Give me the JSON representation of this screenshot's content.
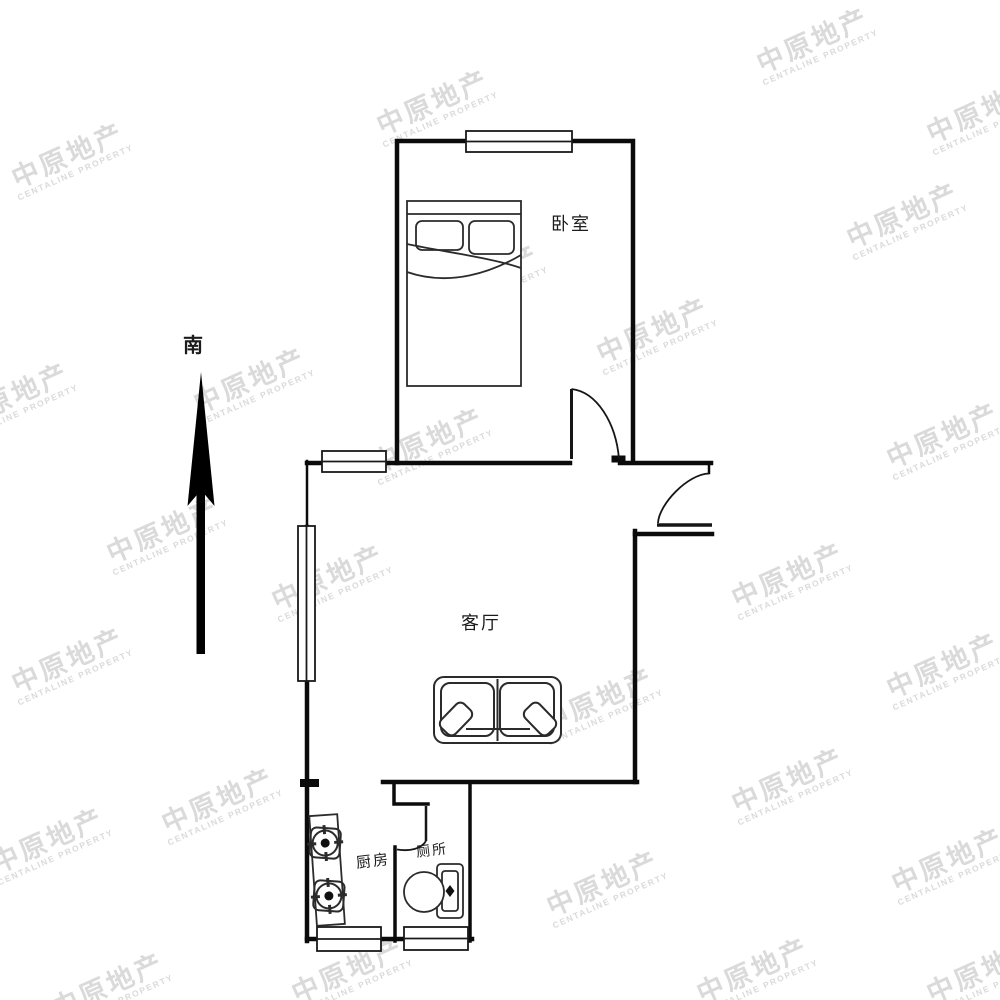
{
  "meta": {
    "background": "#ffffff",
    "line_color": "#111111",
    "furniture_color": "#2b2b2b"
  },
  "watermark": {
    "line1": "中原地产",
    "line2": "CENTALINE PROPERTY",
    "color": "#dadada",
    "rotation_deg": -24,
    "positions": [
      [
        70,
        160
      ],
      [
        435,
        107
      ],
      [
        815,
        45
      ],
      [
        985,
        115
      ],
      [
        15,
        400
      ],
      [
        252,
        385
      ],
      [
        485,
        282
      ],
      [
        655,
        335
      ],
      [
        905,
        220
      ],
      [
        165,
        535
      ],
      [
        430,
        445
      ],
      [
        945,
        440
      ],
      [
        70,
        665
      ],
      [
        330,
        582
      ],
      [
        790,
        580
      ],
      [
        600,
        705
      ],
      [
        945,
        670
      ],
      [
        50,
        845
      ],
      [
        220,
        805
      ],
      [
        790,
        785
      ],
      [
        950,
        865
      ],
      [
        110,
        990
      ],
      [
        350,
        975
      ],
      [
        605,
        888
      ],
      [
        755,
        975
      ],
      [
        985,
        975
      ]
    ]
  },
  "compass": {
    "label": "南"
  },
  "rooms": {
    "bedroom": {
      "label": "卧室"
    },
    "living": {
      "label": "客厅"
    },
    "kitchen": {
      "label": "厨房"
    },
    "toilet": {
      "label": "厕所"
    }
  }
}
